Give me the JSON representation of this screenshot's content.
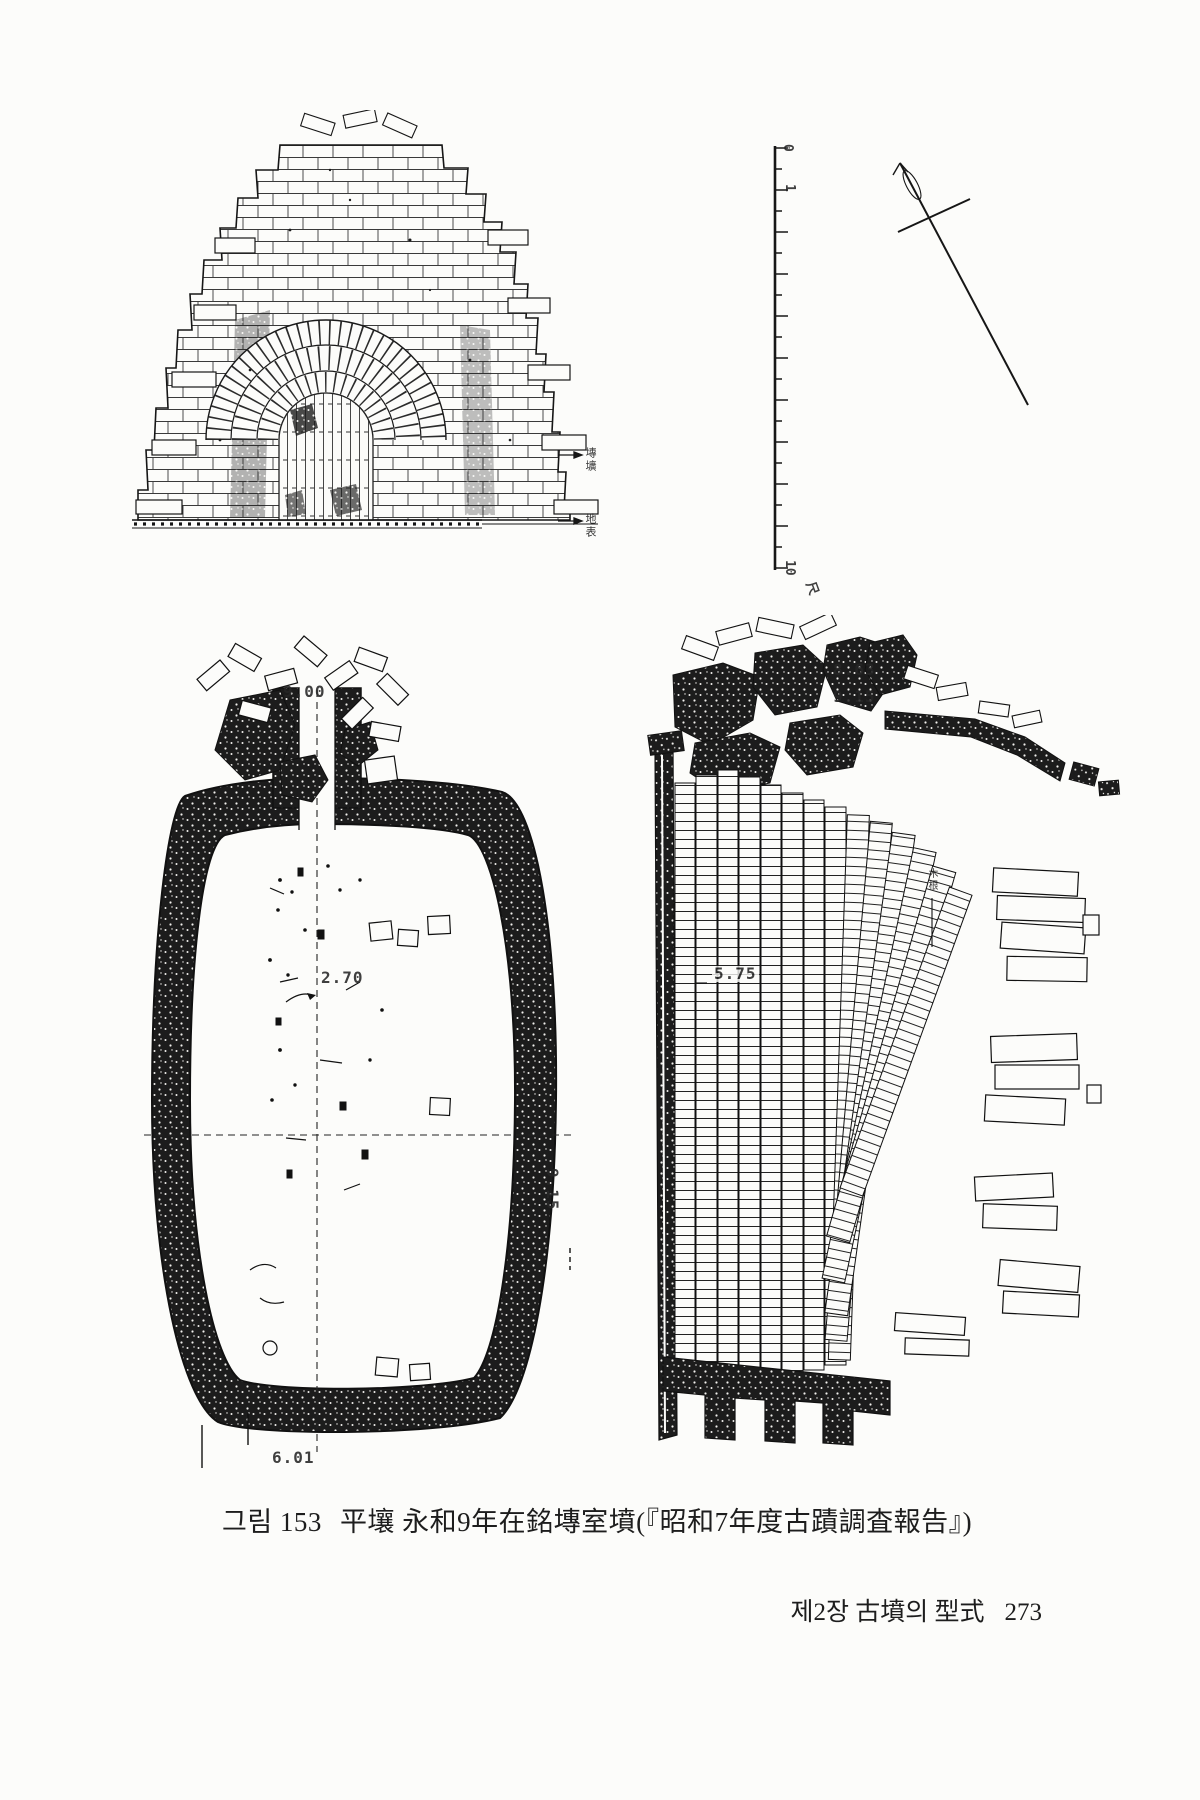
{
  "colors": {
    "ink": "#1d1d1d",
    "paper": "#fcfcfa"
  },
  "figure_caption": {
    "label": "그림 153",
    "title": "平壤 永和9年在銘塼室墳(『昭和7年度古蹟調査報告』)"
  },
  "page_footer": {
    "chapter": "제2장 古墳의 型式",
    "page_number": "273"
  },
  "scale_bar": {
    "tick_0": "0",
    "tick_1": "1",
    "tick_10": "10",
    "unit": "尺"
  },
  "elevation": {
    "annotation_upper": "塼壙",
    "annotation_lower": "地表"
  },
  "plan": {
    "dim_top": "9.00",
    "dim_inner": "2.70",
    "dim_right": "9.15",
    "dim_bottom": "6.01"
  },
  "section": {
    "dim_1": "8.63",
    "dim_2": "9.15",
    "dim_inner": "5.75",
    "annotation": "木根"
  }
}
